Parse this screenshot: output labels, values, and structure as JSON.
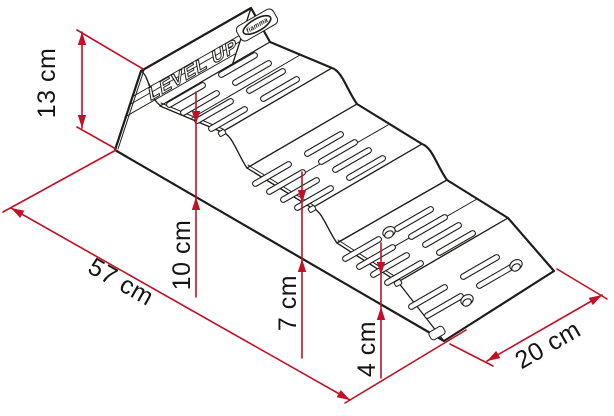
{
  "product": {
    "model_label": "LEVEL UP",
    "brand_label": "fiamma"
  },
  "dimensions": {
    "total_height": {
      "label": "13 cm",
      "value_cm": 13
    },
    "length": {
      "label": "57 cm",
      "value_cm": 57
    },
    "step_high": {
      "label": "10 cm",
      "value_cm": 10
    },
    "step_mid": {
      "label": "7 cm",
      "value_cm": 7
    },
    "step_low": {
      "label": "4 cm",
      "value_cm": 4
    },
    "width": {
      "label": "20 cm",
      "value_cm": 20
    }
  },
  "colors": {
    "dimension_red": "#c21026",
    "line_ink": "#1d1d1b",
    "background": "#ffffff"
  }
}
